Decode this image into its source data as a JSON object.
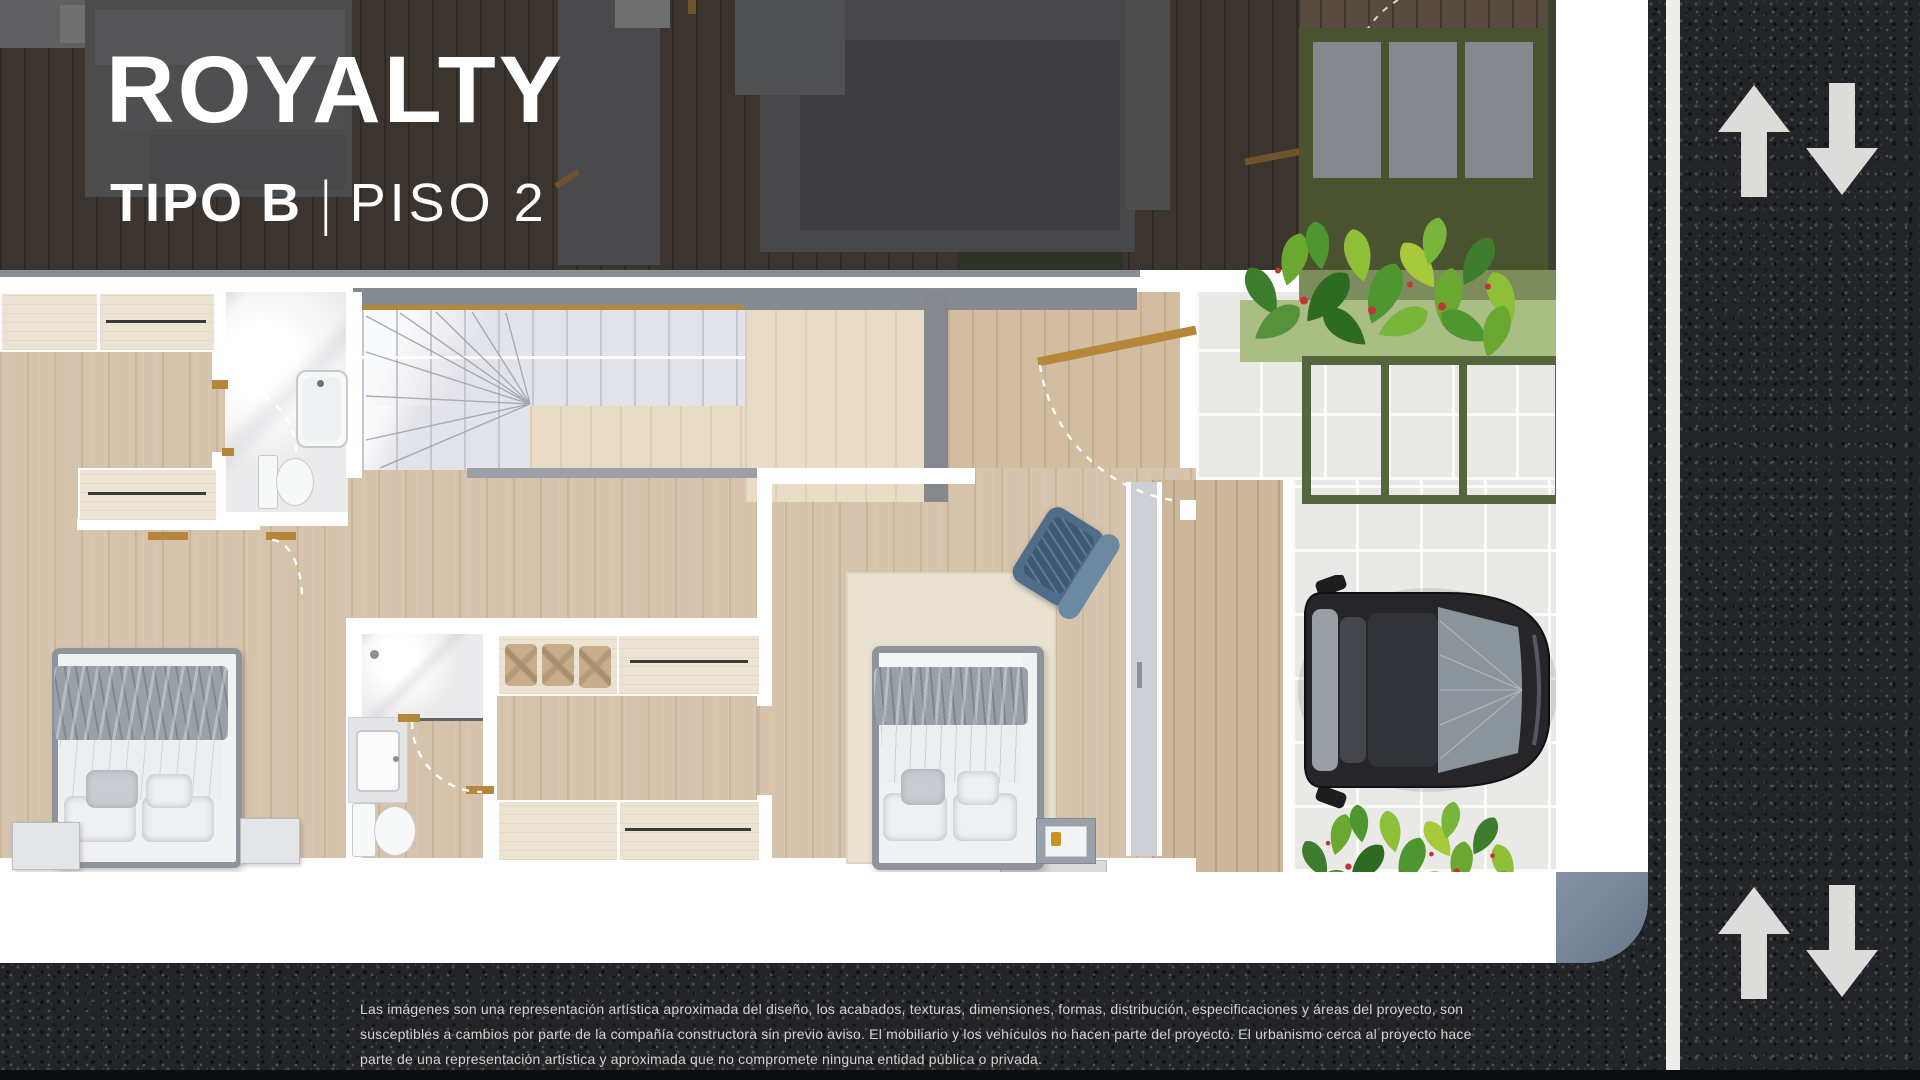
{
  "header": {
    "title": "ROYALTY",
    "type_label": "TIPO B",
    "separator": "|",
    "floor_label": "PISO 2"
  },
  "disclaimer": {
    "lines": [
      "Las imágenes son una representación artística aproximada del diseño, los acabados, texturas, dimensiones, formas, distribución, especificaciones y áreas del proyecto, son",
      "susceptibles a cambios por parte de la compañía constructora sin previo aviso. El mobiliario y los vehículos no hacen parte del proyecto. El urbanismo cerca al proyecto hace",
      "parte de una representación artística y aproximada que no compromete ninguna entidad pública o privada."
    ]
  },
  "road": {
    "up_arrow_icon": "road-up-arrow",
    "down_arrow_icon": "road-down-arrow",
    "lane_line": "white-lane-line"
  },
  "colors": {
    "asphalt": "#222428",
    "sidewalk": "#7e8c9e",
    "wall": "#ffffff",
    "wood_floor": "#d6c3ac",
    "deck_wood": "#ccb79b",
    "marble": "#ebebed",
    "stair_glass": "#e3e4ea",
    "accent_gold": "#b5873a",
    "facade_green": "#4a5230",
    "grass_green": "#a9bd84",
    "plant_green": "#4e9630",
    "chair_blue": "#4f6d88",
    "car_body": "#26262a",
    "title_text": "#ffffff",
    "disclaimer_text": "#d3d3d1"
  }
}
